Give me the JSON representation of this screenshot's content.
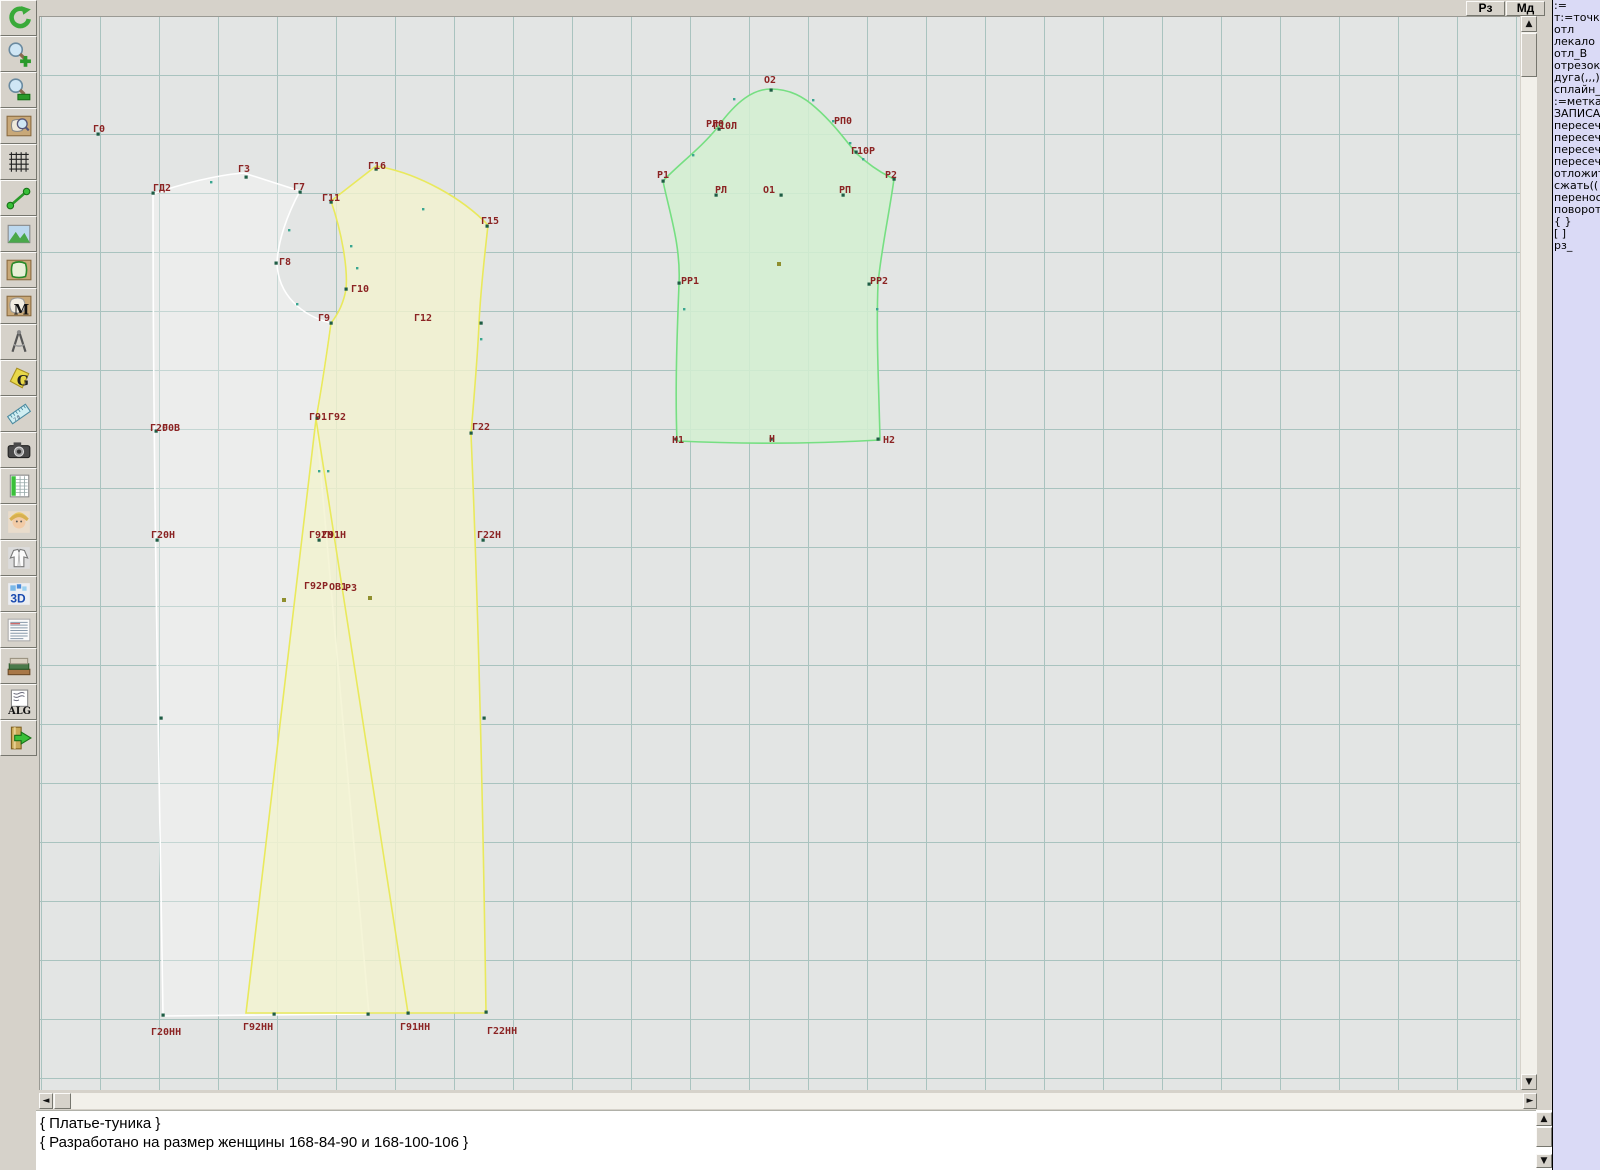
{
  "top_buttons": [
    {
      "label": "Рз"
    },
    {
      "label": "Мд"
    }
  ],
  "toolbar": {
    "buttons": [
      {
        "name": "refresh",
        "icon": "refresh-icon"
      },
      {
        "name": "zoom-in",
        "icon": "zoom-in-icon"
      },
      {
        "name": "zoom-out",
        "icon": "zoom-out-icon"
      },
      {
        "name": "zoom-piece",
        "icon": "zoom-piece-icon"
      },
      {
        "name": "grid",
        "icon": "grid-icon"
      },
      {
        "name": "segment",
        "icon": "segment-icon"
      },
      {
        "name": "image",
        "icon": "image-icon"
      },
      {
        "name": "piece",
        "icon": "pattern-piece-icon"
      },
      {
        "name": "piece-m",
        "icon": "pattern-m-icon"
      },
      {
        "name": "compass",
        "icon": "compass-icon"
      },
      {
        "name": "piece-g",
        "icon": "pattern-g-icon"
      },
      {
        "name": "ruler",
        "icon": "ruler-icon"
      },
      {
        "name": "camera",
        "icon": "camera-icon"
      },
      {
        "name": "table",
        "icon": "table-icon"
      },
      {
        "name": "model",
        "icon": "model-photo-icon"
      },
      {
        "name": "garment",
        "icon": "garment-icon"
      },
      {
        "name": "threed",
        "icon": "3d-icon",
        "label": "3D"
      },
      {
        "name": "text-list",
        "icon": "text-list-icon"
      },
      {
        "name": "books",
        "icon": "books-icon"
      },
      {
        "name": "alg",
        "icon": "alg-icon",
        "label": "ALG"
      },
      {
        "name": "exit",
        "icon": "exit-icon"
      }
    ]
  },
  "command_panel": {
    "items": [
      ":=",
      "т:=точка",
      "отл",
      "лекало",
      "отл_В",
      "отрезок",
      "дуга(,,,)",
      "сплайн_",
      ":=метка",
      "ЗАПИСА",
      "пересеч",
      "пересеч",
      "пересеч",
      "пересеч",
      "отложит",
      "сжать((",
      "перенос",
      "поворот",
      "{ }",
      "[ ]",
      "рз_"
    ]
  },
  "console": {
    "lines": [
      "{ Платье-туника }",
      "{ Разработано на размер женщины 168-84-90 и 168-100-106 }"
    ]
  },
  "canvas": {
    "colors": {
      "background": "#e3e5e4",
      "grid_line": "#a9c3bf",
      "label": "#8b2323",
      "point": "#1e5c44",
      "tick": "#3aa690",
      "olive_dot": "#8f8f2e",
      "back_stroke": "#ffffff",
      "back_fill": "rgba(255,255,255,0.32)",
      "front_stroke": "#e9e95c",
      "front_fill": "rgba(242,242,206,0.8)",
      "sleeve_stroke": "#76df82",
      "sleeve_fill": "rgba(211,240,209,0.85)"
    },
    "pieces": [
      {
        "name": "back-piece",
        "stroke": "#ffffff",
        "fill": "rgba(255,255,255,0.32)",
        "path": "M152,193 C180,183 215,174 243,172 L299,190 C286,214 277,240 276,262 C277,294 301,315 330,322 C325,358 319,396 315,418 L368,1013 L162,1015 C158,760 152,470 152,193 Z"
      },
      {
        "name": "front-piece",
        "stroke": "#e9e95c",
        "fill": "rgba(242,242,206,0.8)",
        "path": "M375,165 L330,200 C341,232 347,268 345,288 C342,306 334,317 330,322 C325,358 319,396 315,418 L245,1012 L485,1012 C482,800 477,600 470,433 C474,385 477,350 478,322 C480,283 484,252 487,224 C462,198 418,172 375,165 Z"
      },
      {
        "name": "sleeve-piece",
        "stroke": "#76df82",
        "fill": "rgba(211,240,209,0.85)",
        "path": "M662,180 C678,163 700,147 716,127 C736,99 753,88 770,88 C789,88 803,96 815,107 C831,121 843,137 855,152 C868,164 880,172 893,178 C888,214 880,250 877,283 C875,335 878,390 879,439 C810,443 740,443 676,440 C674,390 676,334 678,283 C680,244 668,210 662,180 Z"
      }
    ],
    "seam_lines": [
      {
        "name": "front-godet-seam",
        "stroke": "#e9e95c",
        "path": "M315,418 L407,1012"
      }
    ],
    "labels": [
      {
        "t": "Г0",
        "x": 92,
        "y": 131
      },
      {
        "t": "ГД2",
        "x": 152,
        "y": 190
      },
      {
        "t": "Г3",
        "x": 237,
        "y": 171
      },
      {
        "t": "Г7",
        "x": 292,
        "y": 189
      },
      {
        "t": "Г16",
        "x": 367,
        "y": 168
      },
      {
        "t": "Г11",
        "x": 321,
        "y": 200
      },
      {
        "t": "Г15",
        "x": 480,
        "y": 223
      },
      {
        "t": "Г8",
        "x": 278,
        "y": 264
      },
      {
        "t": "Г10",
        "x": 350,
        "y": 291
      },
      {
        "t": "Г9",
        "x": 317,
        "y": 320
      },
      {
        "t": "Г12",
        "x": 413,
        "y": 320
      },
      {
        "t": "Г20",
        "x": 149,
        "y": 430
      },
      {
        "t": "Г0В",
        "x": 161,
        "y": 430
      },
      {
        "t": "Г91",
        "x": 308,
        "y": 419
      },
      {
        "t": "Г92",
        "x": 327,
        "y": 419
      },
      {
        "t": "Г22",
        "x": 471,
        "y": 429
      },
      {
        "t": "Г20Н",
        "x": 150,
        "y": 537
      },
      {
        "t": "Г92Н",
        "x": 308,
        "y": 537
      },
      {
        "t": "Г91Н",
        "x": 321,
        "y": 537
      },
      {
        "t": "Г22Н",
        "x": 476,
        "y": 537
      },
      {
        "t": "Г92Р",
        "x": 303,
        "y": 588
      },
      {
        "t": "ОВ1",
        "x": 328,
        "y": 589
      },
      {
        "t": "Р3",
        "x": 344,
        "y": 590
      },
      {
        "t": "Г20НН",
        "x": 150,
        "y": 1034
      },
      {
        "t": "Г92НН",
        "x": 242,
        "y": 1029
      },
      {
        "t": "Г91НН",
        "x": 399,
        "y": 1029
      },
      {
        "t": "Г22НН",
        "x": 486,
        "y": 1033
      },
      {
        "t": "О2",
        "x": 763,
        "y": 82
      },
      {
        "t": "РЛ0",
        "x": 705,
        "y": 126
      },
      {
        "t": "Г10Л",
        "x": 712,
        "y": 128
      },
      {
        "t": "РП0",
        "x": 833,
        "y": 123
      },
      {
        "t": "Г10Р",
        "x": 850,
        "y": 153
      },
      {
        "t": "Р1",
        "x": 656,
        "y": 177
      },
      {
        "t": "Р2",
        "x": 884,
        "y": 177
      },
      {
        "t": "РЛ",
        "x": 714,
        "y": 192
      },
      {
        "t": "О1",
        "x": 762,
        "y": 192
      },
      {
        "t": "РП",
        "x": 838,
        "y": 192
      },
      {
        "t": "РР1",
        "x": 680,
        "y": 283
      },
      {
        "t": "РР2",
        "x": 869,
        "y": 283
      },
      {
        "t": "Н1",
        "x": 671,
        "y": 442
      },
      {
        "t": "Н",
        "x": 768,
        "y": 441
      },
      {
        "t": "Н2",
        "x": 882,
        "y": 442
      }
    ],
    "points": [
      [
        97,
        133
      ],
      [
        152,
        192
      ],
      [
        245,
        176
      ],
      [
        299,
        191
      ],
      [
        375,
        168
      ],
      [
        330,
        201
      ],
      [
        486,
        225
      ],
      [
        275,
        262
      ],
      [
        345,
        288
      ],
      [
        330,
        322
      ],
      [
        480,
        322
      ],
      [
        155,
        430
      ],
      [
        316,
        417
      ],
      [
        470,
        432
      ],
      [
        156,
        539
      ],
      [
        318,
        539
      ],
      [
        482,
        539
      ],
      [
        160,
        717
      ],
      [
        483,
        717
      ],
      [
        162,
        1014
      ],
      [
        273,
        1013
      ],
      [
        367,
        1013
      ],
      [
        407,
        1012
      ],
      [
        485,
        1011
      ],
      [
        662,
        180
      ],
      [
        770,
        89
      ],
      [
        718,
        128
      ],
      [
        855,
        151
      ],
      [
        893,
        178
      ],
      [
        715,
        194
      ],
      [
        780,
        194
      ],
      [
        842,
        194
      ],
      [
        678,
        282
      ],
      [
        868,
        283
      ],
      [
        675,
        438
      ],
      [
        770,
        438
      ],
      [
        877,
        438
      ]
    ],
    "ticks": [
      [
        210,
        181
      ],
      [
        288,
        229
      ],
      [
        296,
        303
      ],
      [
        350,
        245
      ],
      [
        356,
        267
      ],
      [
        422,
        208
      ],
      [
        480,
        338
      ],
      [
        318,
        470
      ],
      [
        327,
        470
      ],
      [
        692,
        154
      ],
      [
        733,
        98
      ],
      [
        812,
        99
      ],
      [
        832,
        120
      ],
      [
        849,
        142
      ],
      [
        862,
        158
      ],
      [
        683,
        308
      ],
      [
        876,
        308
      ]
    ],
    "olive_dots": [
      [
        778,
        263
      ],
      [
        283,
        599
      ],
      [
        369,
        597
      ]
    ]
  }
}
